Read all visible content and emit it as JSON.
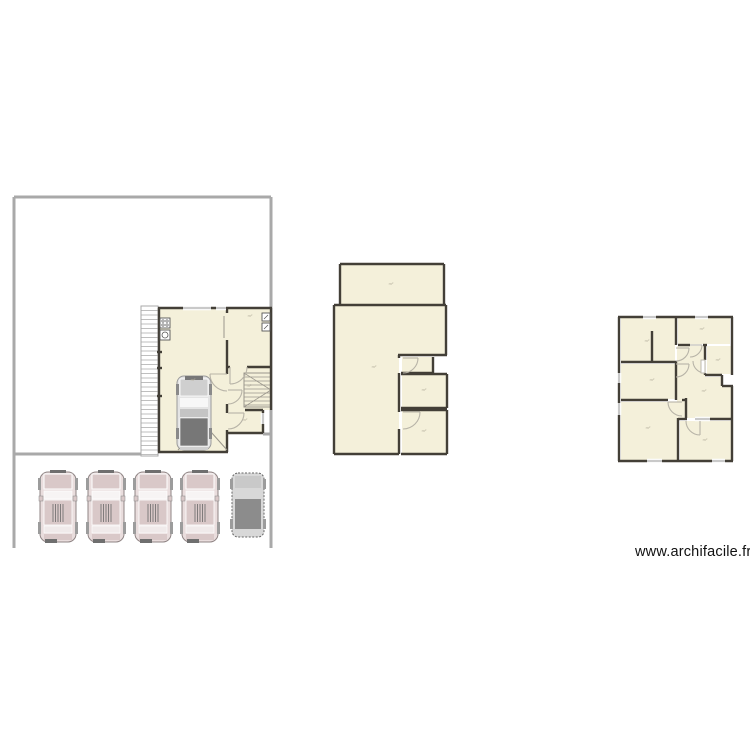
{
  "watermark": {
    "text": "www.archifacile.fr"
  },
  "area_unit_label": "m²",
  "colors": {
    "background": "#ffffff",
    "room_fill": "#f4f0da",
    "wall": "#433f37",
    "boundary": "#a9a9a9",
    "window": "#c9c9c9",
    "door": "#b7b3a7",
    "label": "#b5b09e",
    "stair": "#9a968c",
    "hatch": "#aaaaaa",
    "car_body": "#e9dddd",
    "car_panel": "#d9c8c8",
    "car_dark": "#6f6f6f",
    "van_body": "#d8d8d8",
    "van_roof": "#8c8c8c"
  },
  "plans": [
    {
      "name": "plan-ground-site",
      "boundary": [
        [
          14,
          197,
          271,
          197
        ],
        [
          14,
          197,
          14,
          548
        ],
        [
          271,
          197,
          271,
          548
        ],
        [
          14,
          454,
          142,
          454
        ],
        [
          263,
          434,
          271,
          434
        ]
      ],
      "hatch": [
        {
          "x": 141,
          "y": 306,
          "w": 17,
          "h": 150,
          "gap": 4.5
        }
      ],
      "rooms": [
        {
          "name": "room-garage",
          "x": 159,
          "y": 308,
          "w": 68,
          "h": 144
        },
        {
          "name": "room-entry",
          "x": 227,
          "y": 308,
          "w": 44,
          "h": 59
        },
        {
          "name": "room-stair-hall",
          "x": 227,
          "y": 367,
          "w": 44,
          "h": 43
        },
        {
          "name": "room-small",
          "x": 227,
          "y": 410,
          "w": 36,
          "h": 23
        }
      ],
      "voids": [],
      "stairs": [
        {
          "x": 244,
          "y": 373,
          "w": 27,
          "h": 34
        }
      ],
      "walls": [
        [
          158,
          308,
          272,
          308
        ],
        [
          159,
          308,
          159,
          452
        ],
        [
          158,
          452,
          228,
          452
        ],
        [
          227,
          308,
          227,
          313
        ],
        [
          227,
          340,
          227,
          374
        ],
        [
          227,
          404,
          227,
          413
        ],
        [
          227,
          430,
          227,
          452
        ],
        [
          271,
          308,
          271,
          410
        ],
        [
          227,
          367,
          230,
          367
        ],
        [
          247,
          367,
          271,
          367
        ],
        [
          245,
          410,
          263,
          410
        ],
        [
          263,
          410,
          263,
          433
        ],
        [
          227,
          433,
          263,
          433
        ],
        [
          157,
          352,
          162,
          352
        ],
        [
          157,
          368,
          162,
          368
        ],
        [
          157,
          396,
          162,
          396
        ]
      ],
      "windows": [
        [
          183,
          308,
          211,
          308
        ],
        [
          216,
          308,
          226,
          308
        ],
        [
          263,
          413,
          263,
          424
        ]
      ],
      "doors": [
        {
          "d": "M 210 374 A 17 17 0 0 0 227 391",
          "leaf": [
            227,
            374,
            210,
            374
          ]
        },
        {
          "d": "M 247 367 A 17 17 0 0 1 230 384",
          "leaf": [
            230,
            367,
            230,
            384
          ]
        },
        {
          "d": "M 242 390 A 14 14 0 0 1 228 404",
          "leaf": [
            228,
            390,
            242,
            390
          ]
        },
        {
          "d": "M 244 413 A 16 16 0 0 1 228 429",
          "leaf": [
            228,
            413,
            244,
            413
          ]
        }
      ],
      "thin_lines": [
        [
          178,
          450,
          203,
          423
        ],
        [
          227,
          450,
          203,
          423
        ],
        [
          224,
          316,
          224,
          338
        ]
      ],
      "furniture": [
        {
          "kind": "hob",
          "x": 160,
          "y": 318,
          "w": 10,
          "h": 10
        },
        {
          "kind": "washer",
          "x": 160,
          "y": 330,
          "w": 10,
          "h": 10
        },
        {
          "kind": "unit",
          "x": 262,
          "y": 313,
          "w": 8,
          "h": 8
        },
        {
          "kind": "unit",
          "x": 262,
          "y": 323,
          "w": 8,
          "h": 8
        },
        {
          "kind": "car-top",
          "x": 177,
          "y": 375
        }
      ],
      "labels": [
        {
          "text": "m²",
          "x": 193,
          "y": 381
        },
        {
          "text": "m²",
          "x": 250,
          "y": 317
        },
        {
          "text": "m²",
          "x": 249,
          "y": 387
        },
        {
          "text": "m²",
          "x": 245,
          "y": 421
        }
      ]
    },
    {
      "name": "plan-middle-level",
      "boundary": [],
      "hatch": [],
      "rooms": [
        {
          "name": "room-top",
          "x": 340,
          "y": 264,
          "w": 104,
          "h": 40
        },
        {
          "name": "room-main-a",
          "x": 334,
          "y": 305,
          "w": 112,
          "h": 50
        },
        {
          "name": "room-main-b",
          "x": 334,
          "y": 355,
          "w": 65,
          "h": 99
        },
        {
          "name": "room-wc",
          "x": 402,
          "y": 357,
          "w": 31,
          "h": 16
        },
        {
          "name": "room-mid-right",
          "x": 402,
          "y": 375,
          "w": 45,
          "h": 33
        },
        {
          "name": "room-bottom-right",
          "x": 402,
          "y": 411,
          "w": 45,
          "h": 43
        }
      ],
      "voids": [],
      "stairs": [],
      "walls": [
        [
          340,
          264,
          444,
          264
        ],
        [
          340,
          264,
          340,
          304
        ],
        [
          444,
          264,
          444,
          304
        ],
        [
          334,
          305,
          446,
          305
        ],
        [
          334,
          305,
          334,
          454
        ],
        [
          446,
          305,
          446,
          355
        ],
        [
          398,
          355,
          447,
          355
        ],
        [
          399,
          355,
          399,
          358
        ],
        [
          399,
          373,
          399,
          412
        ],
        [
          399,
          429,
          399,
          454
        ],
        [
          334,
          454,
          399,
          454
        ],
        [
          433,
          357,
          433,
          373
        ],
        [
          401,
          373,
          433,
          373
        ],
        [
          401,
          374,
          447,
          374
        ],
        [
          447,
          374,
          447,
          408
        ],
        [
          401,
          408,
          447,
          408
        ],
        [
          401,
          410,
          447,
          410
        ],
        [
          447,
          410,
          447,
          454
        ],
        [
          401,
          454,
          447,
          454
        ]
      ],
      "windows": [],
      "doors": [
        {
          "d": "M 418 358 A 15 15 0 0 1 403 373",
          "leaf": [
            403,
            358,
            418,
            358
          ]
        },
        {
          "d": "M 420 412 A 17 17 0 0 1 403 429",
          "leaf": [
            403,
            412,
            420,
            412
          ]
        }
      ],
      "thin_lines": [],
      "furniture": [],
      "labels": [
        {
          "text": "m²",
          "x": 391,
          "y": 285
        },
        {
          "text": "m²",
          "x": 374,
          "y": 368
        },
        {
          "text": "m²",
          "x": 424,
          "y": 391
        },
        {
          "text": "m²",
          "x": 424,
          "y": 432
        }
      ]
    },
    {
      "name": "plan-upper-level",
      "boundary": [],
      "hatch": [],
      "rooms": [
        {
          "name": "room-top-left",
          "x": 621,
          "y": 318,
          "w": 54,
          "h": 44
        },
        {
          "name": "room-top-right",
          "x": 678,
          "y": 318,
          "w": 52,
          "h": 26
        },
        {
          "name": "room-small-right",
          "x": 707,
          "y": 346,
          "w": 24,
          "h": 28
        },
        {
          "name": "room-mid-left",
          "x": 621,
          "y": 364,
          "w": 54,
          "h": 35
        },
        {
          "name": "room-hall-a",
          "x": 677,
          "y": 346,
          "w": 28,
          "h": 72
        },
        {
          "name": "room-hall-b",
          "x": 705,
          "y": 377,
          "w": 26,
          "h": 41
        },
        {
          "name": "room-bottom-left",
          "x": 621,
          "y": 402,
          "w": 57,
          "h": 58
        },
        {
          "name": "room-bottom-right",
          "x": 680,
          "y": 421,
          "w": 51,
          "h": 39
        }
      ],
      "voids": [
        {
          "x": 722,
          "y": 375,
          "w": 12,
          "h": 11
        }
      ],
      "stairs": [],
      "walls": [
        [
          618,
          317,
          733,
          317
        ],
        [
          619,
          317,
          619,
          461
        ],
        [
          618,
          461,
          733,
          461
        ],
        [
          732,
          317,
          732,
          375
        ],
        [
          732,
          386,
          732,
          461
        ],
        [
          722,
          375,
          722,
          386
        ],
        [
          722,
          386,
          733,
          386
        ],
        [
          705,
          375,
          722,
          375
        ],
        [
          676,
          317,
          676,
          345
        ],
        [
          676,
          361,
          676,
          400
        ],
        [
          652,
          331,
          652,
          362
        ],
        [
          621,
          362,
          676,
          362
        ],
        [
          621,
          400,
          668,
          400
        ],
        [
          682,
          400,
          686,
          400
        ],
        [
          686,
          398,
          686,
          418
        ],
        [
          678,
          418,
          678,
          461
        ],
        [
          678,
          345,
          690,
          345
        ],
        [
          703,
          345,
          707,
          345
        ],
        [
          705,
          345,
          705,
          360
        ],
        [
          705,
          373,
          705,
          375
        ],
        [
          678,
          419,
          687,
          419
        ],
        [
          700,
          419,
          732,
          419
        ]
      ],
      "windows": [
        [
          643,
          317,
          656,
          317
        ],
        [
          695,
          317,
          708,
          317
        ],
        [
          619,
          373,
          619,
          383
        ],
        [
          619,
          403,
          619,
          415
        ],
        [
          647,
          461,
          662,
          461
        ],
        [
          712,
          461,
          725,
          461
        ],
        [
          695,
          419,
          710,
          419
        ]
      ],
      "doors": [
        {
          "d": "M 689 348 A 13 13 0 0 1 676 361",
          "leaf": [
            676,
            348,
            689,
            348
          ]
        },
        {
          "d": "M 702 345 A 12 12 0 0 1 690 357",
          "leaf": [
            690,
            345,
            702,
            345
          ]
        },
        {
          "d": "M 705 373 A 12 12 0 0 1 693 361",
          "leaf": [
            705,
            361,
            705,
            373
          ]
        },
        {
          "d": "M 689 364 A 13 13 0 0 1 676 377",
          "leaf": [
            676,
            364,
            689,
            364
          ]
        },
        {
          "d": "M 668 402 A 14 14 0 0 0 682 416",
          "leaf": [
            682,
            402,
            668,
            402
          ]
        },
        {
          "d": "M 700 435 A 14 14 0 0 1 686 421",
          "leaf": [
            700,
            421,
            700,
            435
          ]
        }
      ],
      "thin_lines": [],
      "furniture": [
        {
          "kind": "leafrect",
          "x": 701,
          "y": 360,
          "w": 4,
          "h": 13
        }
      ],
      "labels": [
        {
          "text": "m²",
          "x": 647,
          "y": 342
        },
        {
          "text": "m²",
          "x": 702,
          "y": 330
        },
        {
          "text": "m²",
          "x": 718,
          "y": 361
        },
        {
          "text": "m²",
          "x": 652,
          "y": 381
        },
        {
          "text": "m²",
          "x": 704,
          "y": 392
        },
        {
          "text": "m²",
          "x": 648,
          "y": 429
        },
        {
          "text": "m²",
          "x": 705,
          "y": 441
        }
      ]
    }
  ],
  "parked_cars": [
    {
      "type": "suv",
      "x": 38,
      "y": 470
    },
    {
      "type": "suv",
      "x": 86,
      "y": 470
    },
    {
      "type": "suv",
      "x": 133,
      "y": 470
    },
    {
      "type": "suv",
      "x": 180,
      "y": 470
    },
    {
      "type": "van",
      "x": 230,
      "y": 471
    }
  ]
}
